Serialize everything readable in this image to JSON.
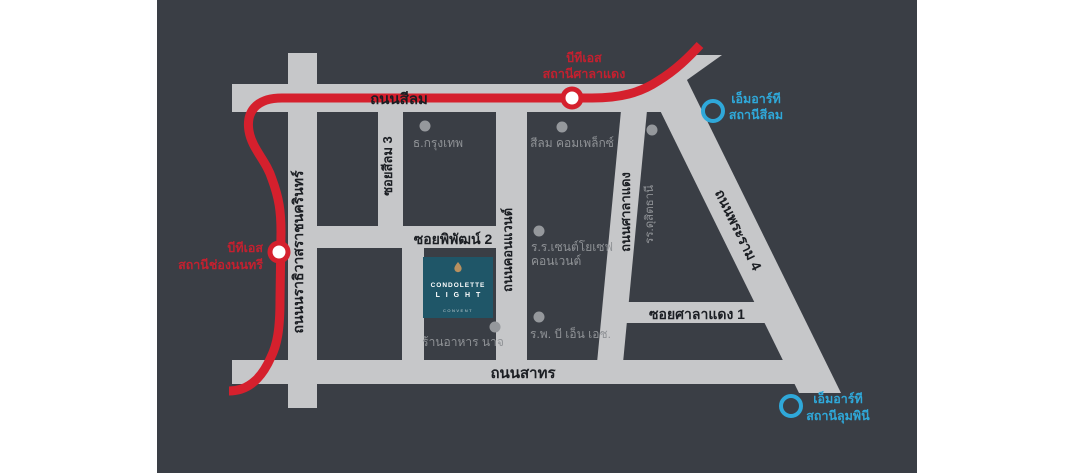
{
  "map": {
    "colors": {
      "background_dark": "#3a3e45",
      "road_gray": "#c6c7c9",
      "bts_line_red": "#d5202d",
      "station_label_red": "#c4202f",
      "mrt_blue": "#2fa8d9",
      "poi_gray": "#95989c",
      "road_text_black": "#1b1e23",
      "logo_teal": "#1f5668",
      "logo_icon_gold": "#b8905f"
    },
    "roads": {
      "silom": "ถนนสีลม",
      "sathorn": "ถนนสาทร",
      "narathiwat": "ถนนนราธิวาสราชนครินทร์",
      "soi_silom3": "ซอยสีลม 3",
      "convent": "ถนนคอนแวนต์",
      "saladaeng": "ถนนศาลาแดง",
      "rama4": "ถนนพระราม 4",
      "soi_pipat2": "ซอยพิพัฒน์ 2",
      "soi_saladaeng1": "ซอยศาลาแดง 1"
    },
    "stations": {
      "bts_saladaeng": {
        "line1": "บีทีเอส",
        "line2": "สถานีศาลาแดง"
      },
      "bts_chongnonsi": {
        "line1": "บีทีเอส",
        "line2": "สถานีช่องนนทรี"
      },
      "mrt_silom": {
        "line1": "เอ็มอาร์ที",
        "line2": "สถานีสีลม"
      },
      "mrt_lumpini": {
        "line1": "เอ็มอาร์ที",
        "line2": "สถานีลุมพินี"
      }
    },
    "pois": {
      "bangkok_bank": "ธ.กรุงเทพ",
      "silom_complex": "สีลม คอมเพล็กซ์",
      "dusit_thani": "รร.ดุสิตธานี",
      "st_joseph_line1": "ร.ร.เซนต์โยเซฟ",
      "st_joseph_line2": "คอนเวนต์",
      "bnh_hospital": "ร.พ. บี เอ็น เอช.",
      "naj_restaurant": "ร้านอาหาร นาจ"
    },
    "logo": {
      "brand": "CONDOLETTE",
      "name": "L I G H T",
      "sub": "CONVENT"
    }
  }
}
